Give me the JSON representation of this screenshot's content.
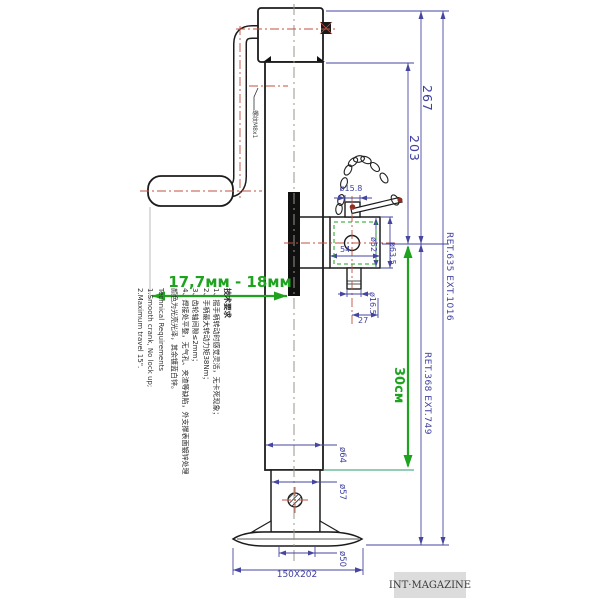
{
  "dims": {
    "height_267": "267",
    "height_203": "203",
    "travel_30cm": "30см",
    "crank_clearance": "17,7мм - 18мм",
    "overall_height": "RET.635  EXT.1016",
    "lower_height": "RET.368  EXT.749",
    "pin_top_dia": "ø15.8",
    "bracket_width": "54",
    "dia_52": "ø52",
    "dia_63_5": "ø63.5",
    "pin_bottom_dia": "ø16.5",
    "pin_offset_27": "27",
    "outer_tube_dia": "ø64",
    "inner_tube_dia": "ø57",
    "foot_neck_dia": "ø50",
    "base_plate": "150X202",
    "thread_callout": "螺纹M8x1"
  },
  "notes_cn": {
    "title": "技术要求",
    "lines": [
      "1、摇手柄转动时感觉灵活，无卡死现象；",
      "2、手柄最大转动力矩38Nm；",
      "3、齿轮轴间隙≤2mm；",
      "4、焊接处平整，无气孔、夹渣等缺陷，外支撑表面镀锌处理",
      "颜色为光亮光泽，其余镀蓝白锌。"
    ]
  },
  "notes_en": {
    "title": "Technical Requirements",
    "lines": [
      "1.Smooth crank, No lock up;",
      "2.Maximum travel 15\"."
    ]
  },
  "watermark": "INT·MAGAZINE",
  "colors": {
    "dimension_blue": "#4646a0",
    "annotation_green": "#1ea31e",
    "centerline_red": "#c05040",
    "outline_black": "#1c1c1c",
    "watermark_bg": "#dcdcdc"
  }
}
